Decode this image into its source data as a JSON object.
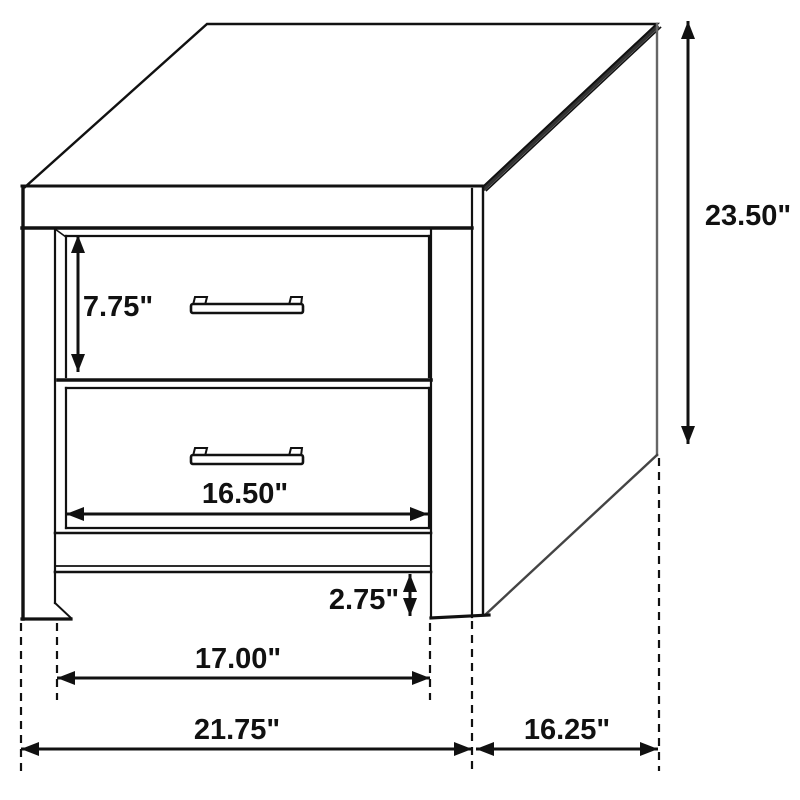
{
  "figure": {
    "unit": "inches",
    "background_color": "#ffffff",
    "line_color": "#111111",
    "labels": {
      "drawer_front_height": "7.75\"",
      "drawer_width": "16.50\"",
      "leg_height": "2.75\"",
      "inner_leg_span": "17.00\"",
      "overall_width": "21.75\"",
      "side_depth": "16.25\"",
      "overall_height": "23.50\""
    }
  }
}
